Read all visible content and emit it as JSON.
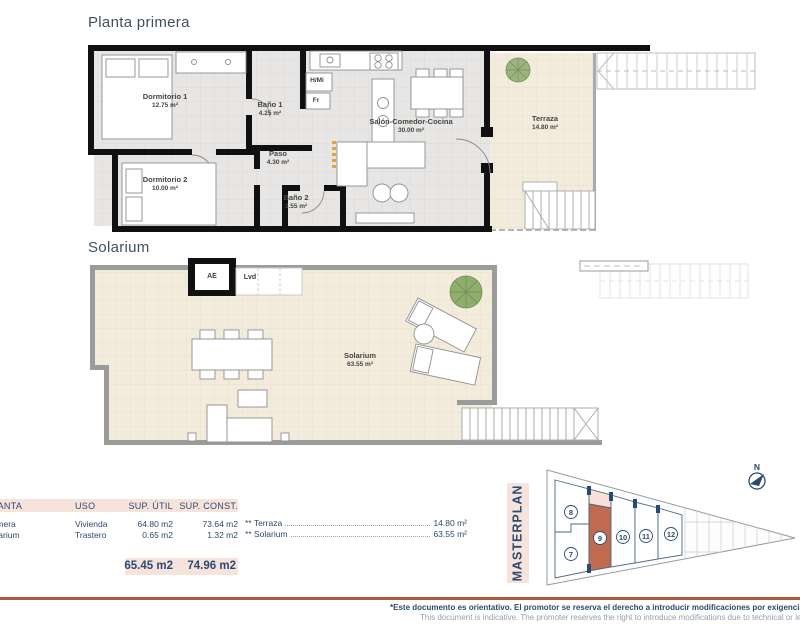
{
  "titles": {
    "plan1": "Planta primera",
    "plan2": "Solarium"
  },
  "plan1": {
    "rooms": [
      {
        "name": "Dormitorio 1",
        "area": "12.75 m²"
      },
      {
        "name": "Baño 1",
        "area": "4.25 m²"
      },
      {
        "name": "Paso",
        "area": "4.30 m²"
      },
      {
        "name": "Dormitorio 2",
        "area": "10.00 m²"
      },
      {
        "name": "Baño 2",
        "area": "3.55 m²"
      },
      {
        "name": "Salón-Comedor-Cocina",
        "area": "30.00 m²"
      },
      {
        "name": "Terraza",
        "area": "14.80 m²"
      }
    ],
    "fixtures": {
      "hmi": "H/Mi",
      "fr": "Fr"
    }
  },
  "plan2": {
    "rooms": [
      {
        "name": "Solarium",
        "area": "63.55 m²"
      }
    ],
    "fixtures": {
      "ae": "AE",
      "lvd": "Lvd"
    }
  },
  "summary_table": {
    "headers": [
      "PLANTA",
      "USO",
      "SUP. ÚTIL",
      "SUP. CONST."
    ],
    "rows": [
      [
        "Primera",
        "Vivienda",
        "64.80 m2",
        "73.64 m2"
      ],
      [
        "Solarium",
        "Trastero",
        "0.65 m2",
        "1.32 m2"
      ]
    ],
    "totals": [
      "65.45 m2",
      "74.96 m2"
    ],
    "notes": [
      {
        "label": "** Terraza",
        "value": "14.80 m²"
      },
      {
        "label": "** Solarium",
        "value": "63.55 m²"
      }
    ]
  },
  "masterplan": {
    "title": "MASTERPLAN",
    "north": "N",
    "units": [
      {
        "number": "8"
      },
      {
        "number": "7"
      },
      {
        "number": "9",
        "highlighted": true
      },
      {
        "number": "10"
      },
      {
        "number": "11"
      },
      {
        "number": "12"
      }
    ]
  },
  "footer": {
    "es": "*Este documento es orientativo. El promotor se reserva el derecho a introducir modificaciones por exigencias técnicas o legales.",
    "en": "This document is indicative. The promoter reserves the right to introduce modifications due to technical or legal requirements."
  },
  "colors": {
    "accent_line": "#ad5a45",
    "highlight_pink": "#f6e3dc",
    "unit_highlight": "#c06a50",
    "navy": "#2b4a70"
  }
}
